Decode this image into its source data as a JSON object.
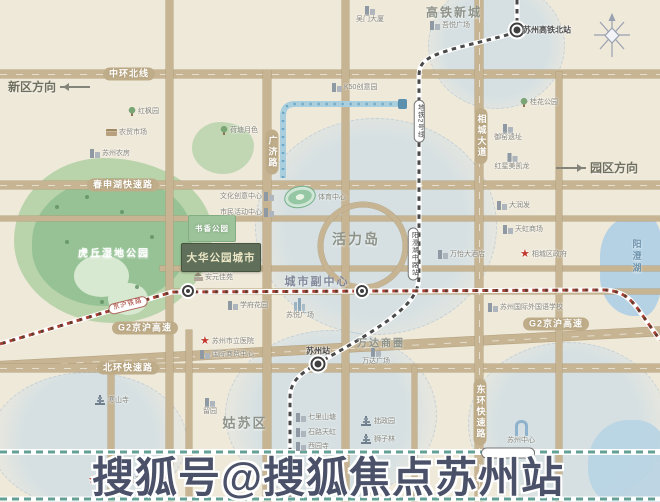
{
  "watermark": {
    "text": "搜狐号@搜狐焦点苏州站"
  },
  "project": {
    "name": "大华公园城市"
  },
  "park_labels": [
    {
      "t": "书香公园"
    }
  ],
  "road_labels": [
    {
      "t": "中环北线",
      "x": 129,
      "y": 74
    },
    {
      "t": "春申湖快速路",
      "x": 123,
      "y": 185
    },
    {
      "t": "G2京沪高速",
      "x": 145,
      "y": 328
    },
    {
      "t": "G2京沪高速",
      "x": 556,
      "y": 324
    },
    {
      "t": "北环快速路",
      "x": 128,
      "y": 368
    },
    {
      "t": "广济路",
      "x": 272,
      "y": 152,
      "v": 1
    },
    {
      "t": "相城大道",
      "x": 481,
      "y": 136,
      "v": 1
    },
    {
      "t": "东环快速路",
      "x": 480,
      "y": 412,
      "v": 1
    }
  ],
  "directions": [
    {
      "t": "新区方向",
      "x": 8,
      "y": 85,
      "dir": "left"
    },
    {
      "t": "园区方向",
      "x": 556,
      "y": 166,
      "dir": "right"
    }
  ],
  "areas": [
    {
      "t": "高铁新城",
      "x": 454,
      "y": 12,
      "s": 12
    },
    {
      "t": "活力岛",
      "x": 356,
      "y": 239,
      "s": 14
    },
    {
      "t": "城市副中心",
      "x": 317,
      "y": 281,
      "s": 11,
      "c": "#7f8698"
    },
    {
      "t": "万达商圈",
      "x": 381,
      "y": 342,
      "s": 10
    },
    {
      "t": "姑苏区",
      "x": 245,
      "y": 422,
      "s": 13
    },
    {
      "t": "虎丘湿地公园",
      "x": 114,
      "y": 252,
      "s": 10,
      "c": "#ffffff"
    },
    {
      "t": "阳澄湖",
      "x": 637,
      "y": 257,
      "s": 9,
      "v": 1,
      "c": "#6d93ad"
    }
  ],
  "stations": [
    {
      "t": "苏州高铁北站",
      "x": 517,
      "y": 30,
      "lx": 547,
      "ly": 30
    },
    {
      "t": "苏州站",
      "x": 318,
      "y": 364,
      "lx": 318,
      "ly": 351
    },
    {
      "t": "",
      "x": 188,
      "y": 291
    },
    {
      "t": "",
      "x": 362,
      "y": 291
    }
  ],
  "rail_pills": [
    {
      "t": "地铁2号线",
      "x": 419,
      "y": 121,
      "v": 1
    },
    {
      "t": "阳澄湖中路站",
      "x": 413,
      "y": 254,
      "v": 1
    },
    {
      "t": "京沪铁路",
      "x": 128,
      "y": 305,
      "r": -14,
      "red": 1
    },
    {
      "t": "",
      "x": 508,
      "y": 453,
      "w": 44
    }
  ],
  "pois": [
    {
      "t": "红枫园",
      "x": 128,
      "y": 107,
      "i": "tree"
    },
    {
      "t": "农贸市场",
      "x": 106,
      "y": 129,
      "i": "market"
    },
    {
      "t": "苏州农房",
      "x": 90,
      "y": 149,
      "i": "building"
    },
    {
      "t": "荷塘月色",
      "x": 220,
      "y": 126,
      "i": "tree"
    },
    {
      "t": "吴门大厦",
      "x": 370,
      "y": 6,
      "i": "building",
      "lay": "v"
    },
    {
      "t": "K50创意园",
      "x": 332,
      "y": 83,
      "i": "building"
    },
    {
      "t": "吾悦广场",
      "x": 430,
      "y": 21,
      "i": "building"
    },
    {
      "t": "桂花公园",
      "x": 520,
      "y": 98,
      "i": "tree"
    },
    {
      "t": "御窑遗址",
      "x": 508,
      "y": 124,
      "i": "building",
      "lay": "v"
    },
    {
      "t": "红星美凯龙",
      "x": 512,
      "y": 153,
      "i": "building",
      "lay": "v"
    },
    {
      "t": "大润发",
      "x": 497,
      "y": 201,
      "i": "building"
    },
    {
      "t": "天虹商场",
      "x": 503,
      "y": 225,
      "i": "building"
    },
    {
      "t": "相城区政府",
      "x": 520,
      "y": 249,
      "i": "star"
    },
    {
      "t": "万怡大酒店",
      "x": 438,
      "y": 250,
      "i": "building"
    },
    {
      "t": "苏州国际外国语学校",
      "x": 488,
      "y": 303,
      "i": "building"
    },
    {
      "t": "体育中心",
      "x": 284,
      "y": 186,
      "i": "stadium"
    },
    {
      "t": "文化创意中心",
      "x": 220,
      "y": 192,
      "i": "building",
      "lay": "rh"
    },
    {
      "t": "市民活动中心",
      "x": 220,
      "y": 208,
      "i": "building",
      "lay": "rh"
    },
    {
      "t": "安元佳苑",
      "x": 194,
      "y": 273,
      "i": "house"
    },
    {
      "t": "学府花园",
      "x": 228,
      "y": 301,
      "i": "building"
    },
    {
      "t": "苏悦广场",
      "x": 300,
      "y": 298,
      "i": "towers",
      "lay": "v"
    },
    {
      "t": "万达广场",
      "x": 376,
      "y": 348,
      "i": "building",
      "lay": "v"
    },
    {
      "t": "苏州市立医院",
      "x": 200,
      "y": 336,
      "i": "star"
    },
    {
      "t": "国际商贸中心",
      "x": 200,
      "y": 350,
      "i": "building"
    },
    {
      "t": "七里山塘",
      "x": 296,
      "y": 413,
      "i": "building"
    },
    {
      "t": "石路天虹",
      "x": 296,
      "y": 428,
      "i": "building"
    },
    {
      "t": "西园寺",
      "x": 296,
      "y": 442,
      "i": "building"
    },
    {
      "t": "拙政园",
      "x": 360,
      "y": 416,
      "i": "pagoda"
    },
    {
      "t": "狮子林",
      "x": 360,
      "y": 434,
      "i": "pagoda"
    },
    {
      "t": "留园",
      "x": 210,
      "y": 398,
      "i": "building",
      "lay": "v"
    },
    {
      "t": "寒山寺",
      "x": 94,
      "y": 395,
      "i": "pagoda"
    },
    {
      "t": "苏州市人民政府",
      "x": 88,
      "y": 475,
      "i": "star"
    },
    {
      "t": "苏州中心",
      "x": 521,
      "y": 420,
      "i": "gate",
      "lay": "v"
    }
  ]
}
